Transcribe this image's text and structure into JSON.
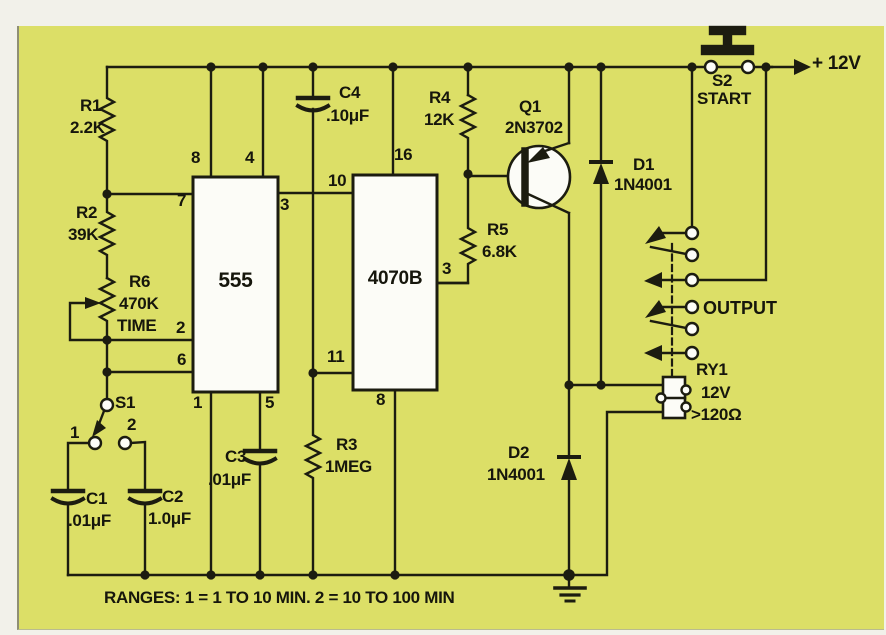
{
  "schematic": {
    "background_color": "#dcdf67",
    "line_color": "#1c1c10",
    "ic_fill_color": "#fcfcf7",
    "power_rail_label": "+ 12V",
    "output_label": "OUTPUT",
    "note": "RANGES: 1 = 1 TO 10 MIN. 2 = 10 TO 100 MIN"
  },
  "components": {
    "r1": {
      "ref": "R1",
      "value": "2.2K"
    },
    "r2": {
      "ref": "R2",
      "value": "39K"
    },
    "r3": {
      "ref": "R3",
      "value": "1MEG"
    },
    "r4": {
      "ref": "R4",
      "value": "12K"
    },
    "r5": {
      "ref": "R5",
      "value": "6.8K"
    },
    "r6": {
      "ref": "R6",
      "value": "470K",
      "function": "TIME"
    },
    "c1": {
      "ref": "C1",
      "value": ".01μF"
    },
    "c2": {
      "ref": "C2",
      "value": "1.0μF"
    },
    "c3": {
      "ref": "C3",
      "value": ".01μF"
    },
    "c4": {
      "ref": "C4",
      "value": ".10μF"
    },
    "d1": {
      "ref": "D1",
      "value": "1N4001"
    },
    "d2": {
      "ref": "D2",
      "value": "1N4001"
    },
    "q1": {
      "ref": "Q1",
      "value": "2N3702"
    },
    "s1": {
      "ref": "S1",
      "pos1": "1",
      "pos2": "2"
    },
    "s2": {
      "ref": "S2",
      "function": "START"
    },
    "ry1": {
      "ref": "RY1",
      "value": "12V",
      "coil_resistance": ">120Ω"
    },
    "ic1": {
      "label": "555",
      "pins": {
        "p8": "8",
        "p4": "4",
        "p7": "7",
        "p3": "3",
        "p2": "2",
        "p6": "6",
        "p1": "1",
        "p5": "5"
      }
    },
    "ic2": {
      "label": "4070B",
      "pins": {
        "p16": "16",
        "p10": "10",
        "p3": "3",
        "p11": "11",
        "p8": "8"
      }
    }
  }
}
